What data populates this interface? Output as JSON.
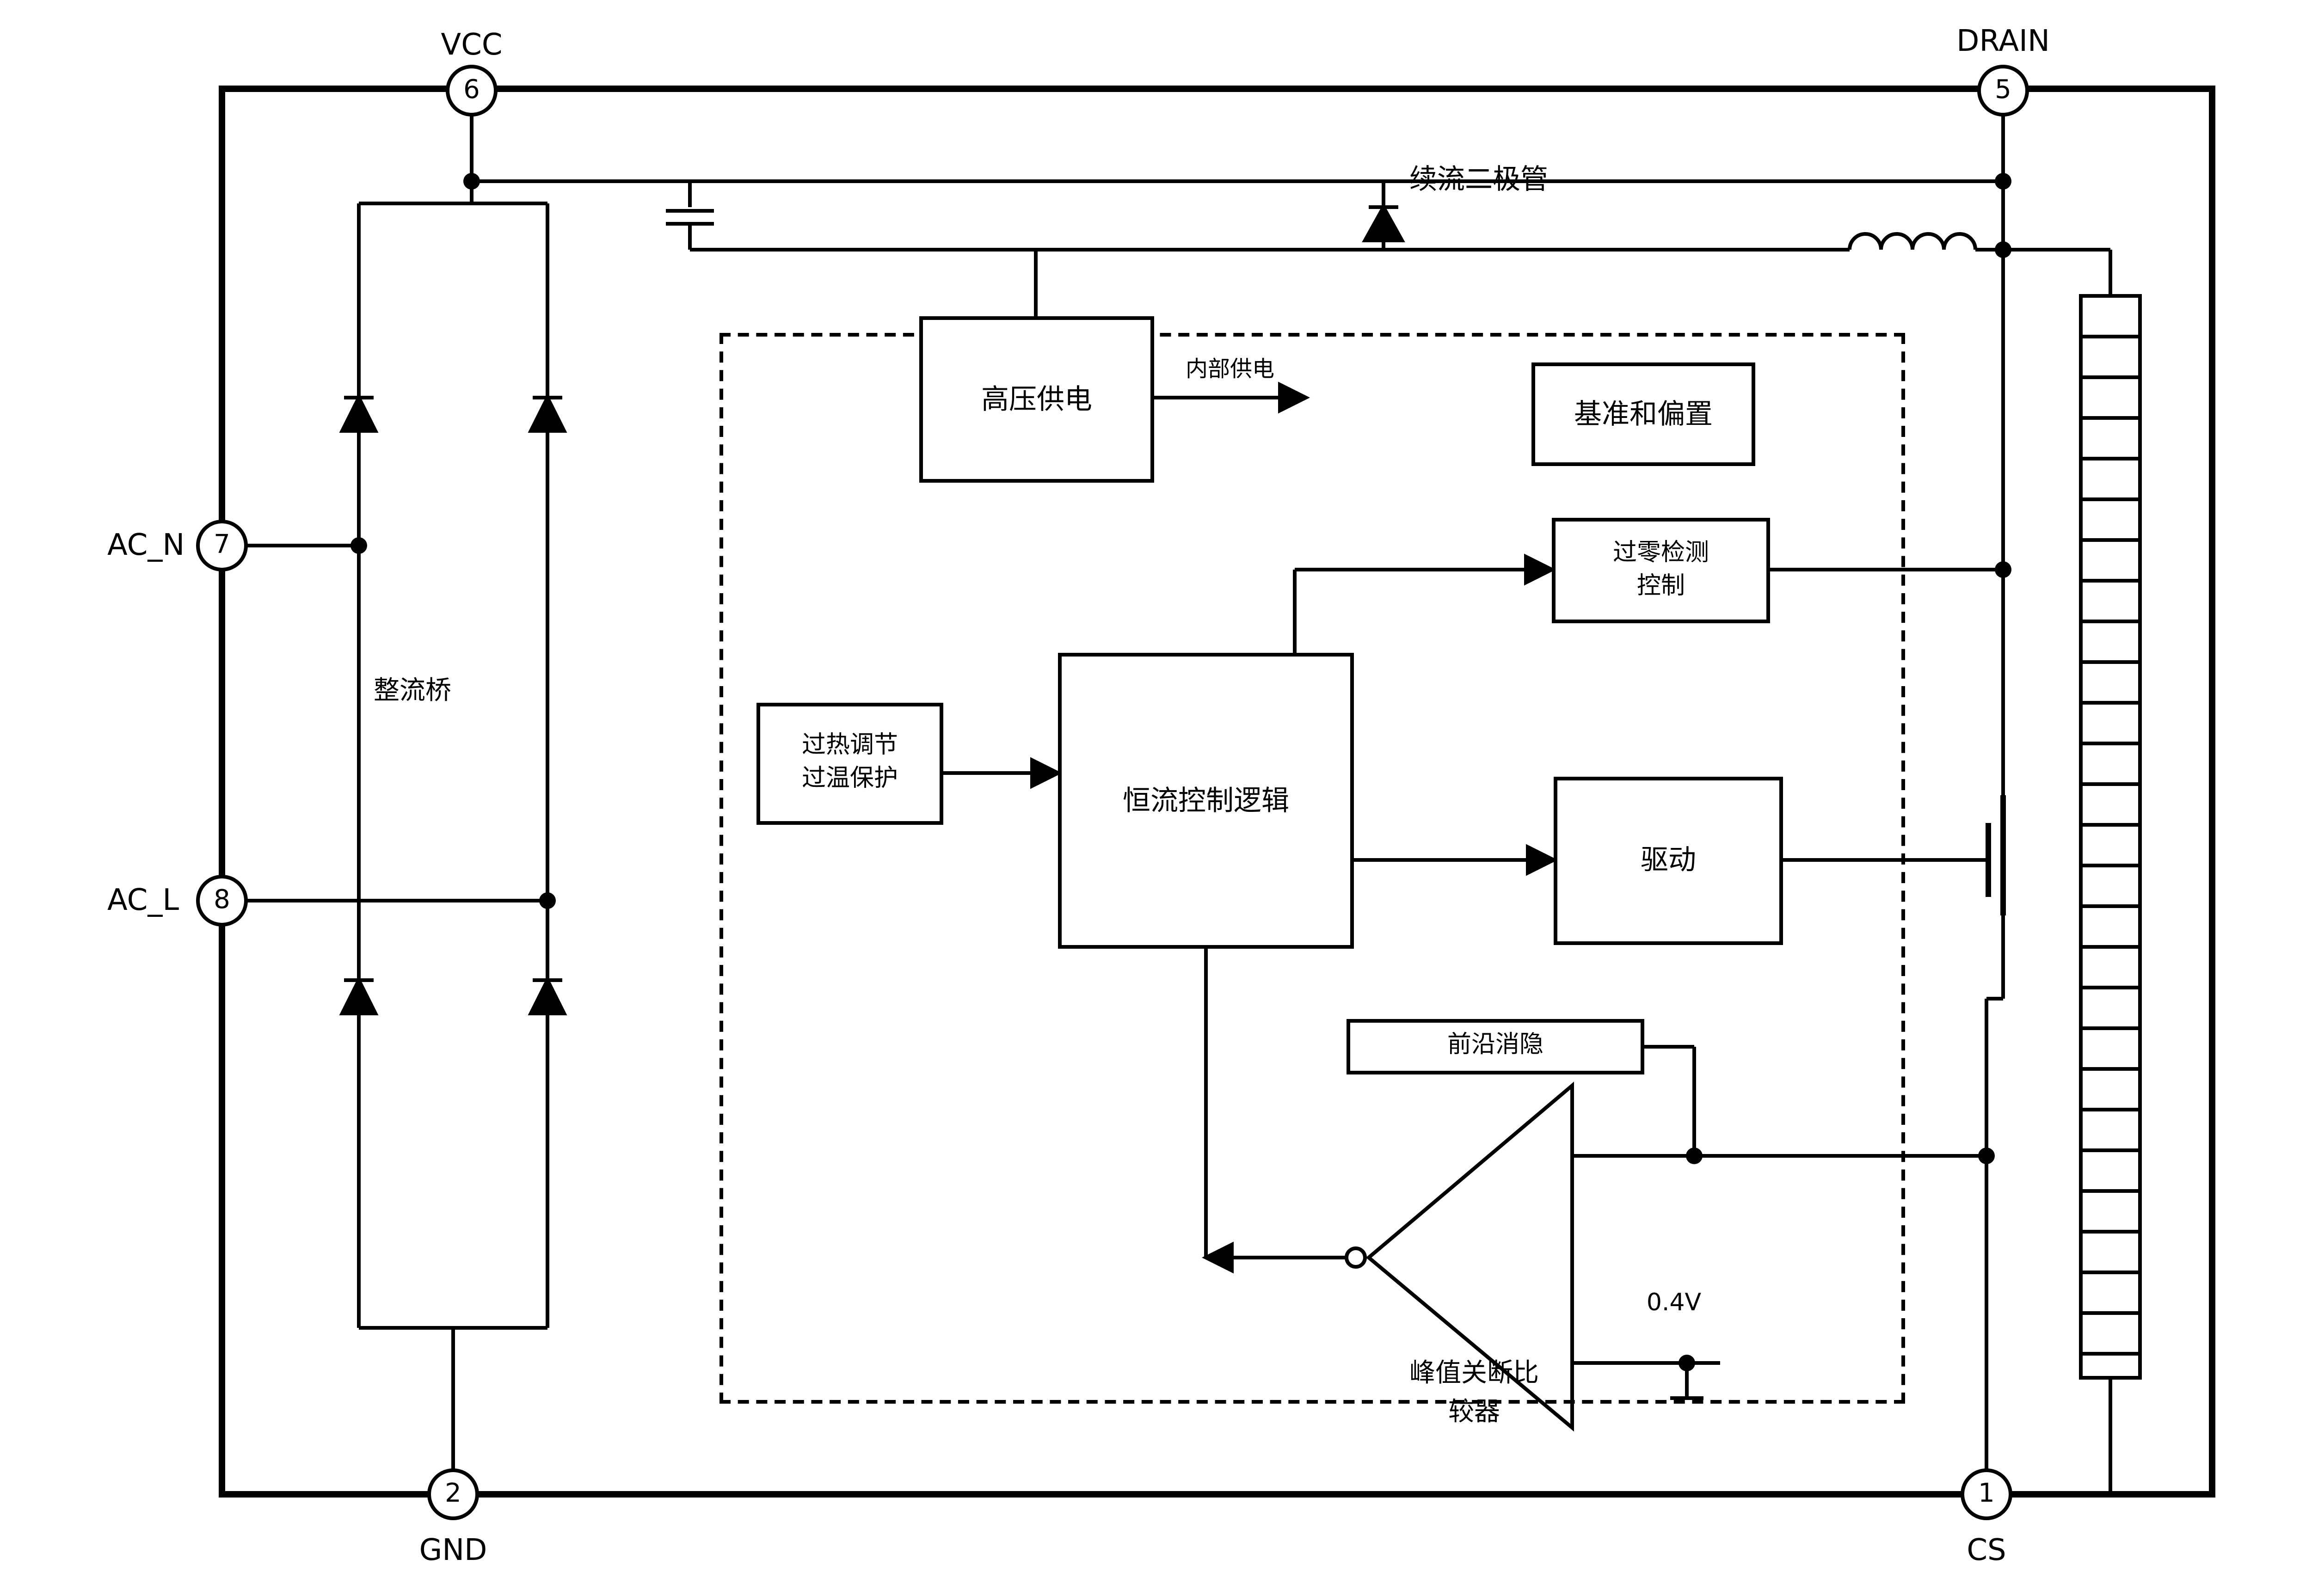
{
  "diagram_title": "LED driver IC internal block diagram",
  "pins": {
    "vcc": {
      "num": "6",
      "label": "VCC"
    },
    "drain": {
      "num": "5",
      "label": "DRAIN"
    },
    "acn": {
      "num": "7",
      "label": "AC_N"
    },
    "acl": {
      "num": "8",
      "label": "AC_L"
    },
    "gnd": {
      "num": "2",
      "label": "GND"
    },
    "cs": {
      "num": "1",
      "label": "CS"
    }
  },
  "blocks": {
    "hv_supply": "高压供电",
    "ref_bias": "基准和偏置",
    "zcd_line1": "过零检测",
    "zcd_line2": "控制",
    "otp_line1": "过热调节",
    "otp_line2": "过温保护",
    "cc_logic": "恒流控制逻辑",
    "driver": "驱动",
    "leb": "前沿消隐"
  },
  "labels": {
    "freewheel_diode": "续流二极管",
    "internal_supply": "内部供电",
    "rectifier_bridge": "整流桥",
    "peak_cmp_line1": "峰值关断比",
    "peak_cmp_line2": "较器",
    "vref": "0.4V"
  },
  "colors": {
    "ink": "#000000",
    "background": "#ffffff"
  }
}
